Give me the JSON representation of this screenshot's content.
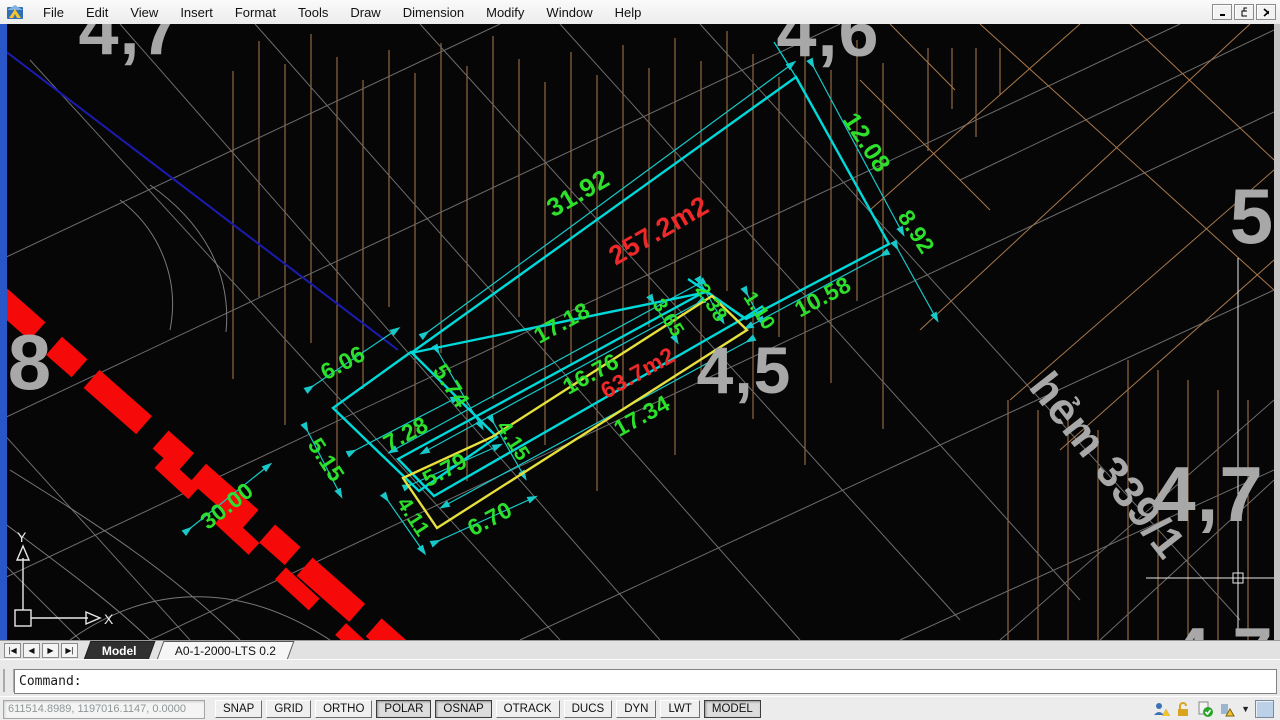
{
  "window": {
    "menu": [
      "File",
      "Edit",
      "View",
      "Insert",
      "Format",
      "Tools",
      "Draw",
      "Dimension",
      "Modify",
      "Window",
      "Help"
    ],
    "control_icons": [
      "minimize-icon",
      "restore-icon",
      "close-icon"
    ]
  },
  "canvas": {
    "dimensions": [
      {
        "text": "31.92",
        "x": 578,
        "y": 193,
        "rot": -30,
        "size": 26
      },
      {
        "text": "257.2m2",
        "x": 659,
        "y": 231,
        "rot": -30,
        "size": 27,
        "color": "#ef2929",
        "name": "area-value-label"
      },
      {
        "text": "12.08",
        "x": 866,
        "y": 143,
        "rot": 57,
        "size": 25
      },
      {
        "text": "8.92",
        "x": 916,
        "y": 232,
        "rot": 57,
        "size": 23
      },
      {
        "text": "10.58",
        "x": 823,
        "y": 297,
        "rot": -28,
        "size": 23
      },
      {
        "text": "17.18",
        "x": 562,
        "y": 323,
        "rot": -29,
        "size": 23
      },
      {
        "text": "16.76",
        "x": 591,
        "y": 374,
        "rot": -29,
        "size": 23
      },
      {
        "text": "63.7m2",
        "x": 638,
        "y": 373,
        "rot": -29,
        "size": 23,
        "color": "#ef2929",
        "name": "area-value-label"
      },
      {
        "text": "17.34",
        "x": 642,
        "y": 416,
        "rot": -29,
        "size": 23
      },
      {
        "text": "3.65",
        "x": 668,
        "y": 318,
        "rot": 57,
        "size": 20
      },
      {
        "text": "2.38",
        "x": 711,
        "y": 303,
        "rot": 57,
        "size": 20
      },
      {
        "text": "1.10",
        "x": 759,
        "y": 311,
        "rot": 57,
        "size": 20
      },
      {
        "text": "6.06",
        "x": 343,
        "y": 363,
        "rot": -28,
        "size": 23
      },
      {
        "text": "5.74",
        "x": 451,
        "y": 386,
        "rot": 57,
        "size": 23
      },
      {
        "text": "7.28",
        "x": 406,
        "y": 434,
        "rot": -28,
        "size": 23
      },
      {
        "text": "5.15",
        "x": 326,
        "y": 460,
        "rot": 57,
        "size": 23
      },
      {
        "text": "4.15",
        "x": 513,
        "y": 441,
        "rot": 57,
        "size": 21
      },
      {
        "text": "5.79",
        "x": 445,
        "y": 470,
        "rot": -28,
        "size": 23
      },
      {
        "text": "4.11",
        "x": 413,
        "y": 517,
        "rot": 57,
        "size": 21
      },
      {
        "text": "6.70",
        "x": 490,
        "y": 519,
        "rot": -28,
        "size": 23
      },
      {
        "text": "30.00",
        "x": 227,
        "y": 506,
        "rot": -38,
        "size": 23
      }
    ],
    "area_labels": [
      {
        "text": "4,7",
        "x": 130,
        "y": 30,
        "size": 72
      },
      {
        "text": "4,6",
        "x": 828,
        "y": 32,
        "size": 72
      },
      {
        "text": "8",
        "x": 30,
        "y": 362,
        "size": 78
      },
      {
        "text": "4,5",
        "x": 744,
        "y": 370,
        "size": 66
      },
      {
        "text": "5",
        "x": 1252,
        "y": 216,
        "size": 78
      },
      {
        "text": "4,7",
        "x": 1208,
        "y": 494,
        "size": 78
      },
      {
        "text": "4,7",
        "x": 1222,
        "y": 654,
        "size": 72
      },
      {
        "text": "hẻm 339/1",
        "x": 1107,
        "y": 466,
        "rot": 52,
        "size": 44,
        "name": "street-label"
      }
    ],
    "ucs": {
      "x_label": "X",
      "y_label": "Y"
    },
    "colors": {
      "parcel_cyan": "#00d9d9",
      "parcel_yellow": "#e6df3c",
      "dim_green": "#2ce02c",
      "area_red": "#ef2929",
      "road_band_red": "#f60909",
      "map_gray": "#a8a8a8",
      "hatch_tan": "#aa7a4c"
    }
  },
  "tabs": {
    "nav_glyphs": [
      "|◀",
      "◀",
      "▶",
      "▶|"
    ],
    "model": "Model",
    "layout": "A0-1-2000-LTS 0.2"
  },
  "command_line": {
    "prompt": "Command:"
  },
  "status_bar": {
    "coordinates": "611514.8989, 1197016.1147, 0.0000",
    "toggles": [
      {
        "label": "SNAP",
        "pressed": false
      },
      {
        "label": "GRID",
        "pressed": false
      },
      {
        "label": "ORTHO",
        "pressed": false
      },
      {
        "label": "POLAR",
        "pressed": true
      },
      {
        "label": "OSNAP",
        "pressed": true
      },
      {
        "label": "OTRACK",
        "pressed": false
      },
      {
        "label": "DUCS",
        "pressed": false
      },
      {
        "label": "DYN",
        "pressed": false
      },
      {
        "label": "LWT",
        "pressed": false
      },
      {
        "label": "MODEL",
        "pressed": true
      }
    ],
    "tray_icons": [
      "standards-warning-icon",
      "ui-lock-icon",
      "trusted-dwg-icon",
      "annotation-warning-icon"
    ],
    "tray_arrow_icon": "tray-menu-arrow-icon",
    "clean_screen_icon": "clean-screen-icon"
  }
}
